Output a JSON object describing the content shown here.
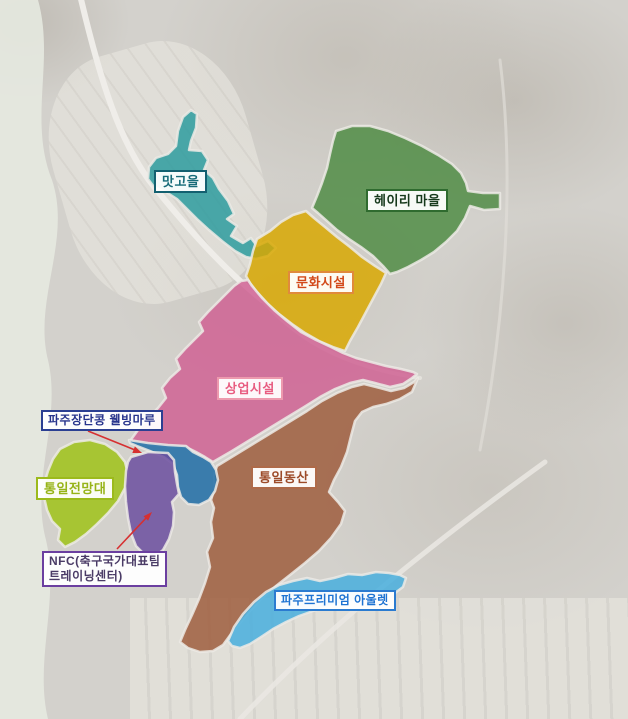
{
  "map": {
    "description": "aerial zoning map with labeled colored districts",
    "background_color": "#d3d1cc",
    "arrow_color": "#d63031",
    "regions": [
      {
        "id": "matgoeul",
        "label": "맛고을",
        "fill": "#2b9b9d",
        "text_color": "#176b79",
        "border_color": "#136070"
      },
      {
        "id": "heyri-village",
        "label": "헤이리 마을",
        "fill": "#4f8c44",
        "text_color": "#16391b",
        "border_color": "#2f6b2f"
      },
      {
        "id": "cultural-facilities",
        "label": "문화시설",
        "fill": "#d9a800",
        "text_color": "#d2491a",
        "border_color": "#e08a3c"
      },
      {
        "id": "commercial-facilities",
        "label": "상업시설",
        "fill": "#cf6092",
        "text_color": "#e85c80",
        "border_color": "#ed9aae"
      },
      {
        "id": "tongil-dongsan",
        "label": "통일동산",
        "fill": "#9d5c3b",
        "text_color": "#9c4a28",
        "border_color": "#ae6a49"
      },
      {
        "id": "paju-jangdankong-wellbeing-maru",
        "label": "파주장단콩 웰빙마루",
        "fill": "#1d6ba6",
        "text_color": "#27348c",
        "border_color": "#2b3f92"
      },
      {
        "id": "tongil-observatory",
        "label": "통일전망대",
        "fill": "#9ec216",
        "text_color": "#96b317",
        "border_color": "#9cba1c"
      },
      {
        "id": "nfc-training-center",
        "label": "NFC(축구국가대표팀 트레이닝센터)",
        "lines": [
          "NFC(축구국가대표팀",
          "트레이닝센터)"
        ],
        "fill": "#6a4c9f",
        "text_color": "#4a3b66",
        "border_color": "#6b3fa0"
      },
      {
        "id": "paju-premium-outlet",
        "label": "파주프리미엄 아울렛",
        "fill": "#46aede",
        "text_color": "#1e73d2",
        "border_color": "#2b7bd0"
      }
    ]
  }
}
